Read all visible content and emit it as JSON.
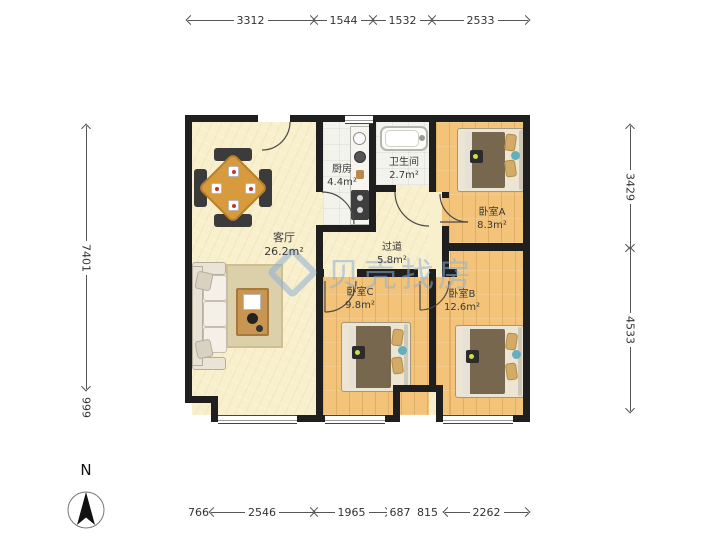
{
  "plan": {
    "rooms": [
      {
        "name": "客厅",
        "area": "26.2m²"
      },
      {
        "name": "厨房",
        "area": "4.4m²"
      },
      {
        "name": "卫生间",
        "area": "2.7m²"
      },
      {
        "name": "卧室A",
        "area": "8.3m²"
      },
      {
        "name": "过道",
        "area": "5.8m²"
      },
      {
        "name": "卧室C",
        "area": "9.8m²"
      },
      {
        "name": "卧室B",
        "area": "12.6m²"
      }
    ]
  },
  "dimensions": {
    "top": [
      "3312",
      "1544",
      "1532",
      "2533"
    ],
    "bottom": [
      "766",
      "2546",
      "1965",
      "687",
      "815",
      "2262"
    ],
    "left": [
      "7401",
      "999"
    ],
    "right": [
      "3429",
      "4533"
    ]
  },
  "watermark": {
    "text": "贝壳找房"
  },
  "compass": {
    "label": "N"
  },
  "colors": {
    "wall": "#1f1f1f",
    "cream_floor": "#f8efcc",
    "wood_floor": "#f2c378",
    "tile_floor": "#f3f3ee",
    "watermark": "#8fb0d8"
  }
}
